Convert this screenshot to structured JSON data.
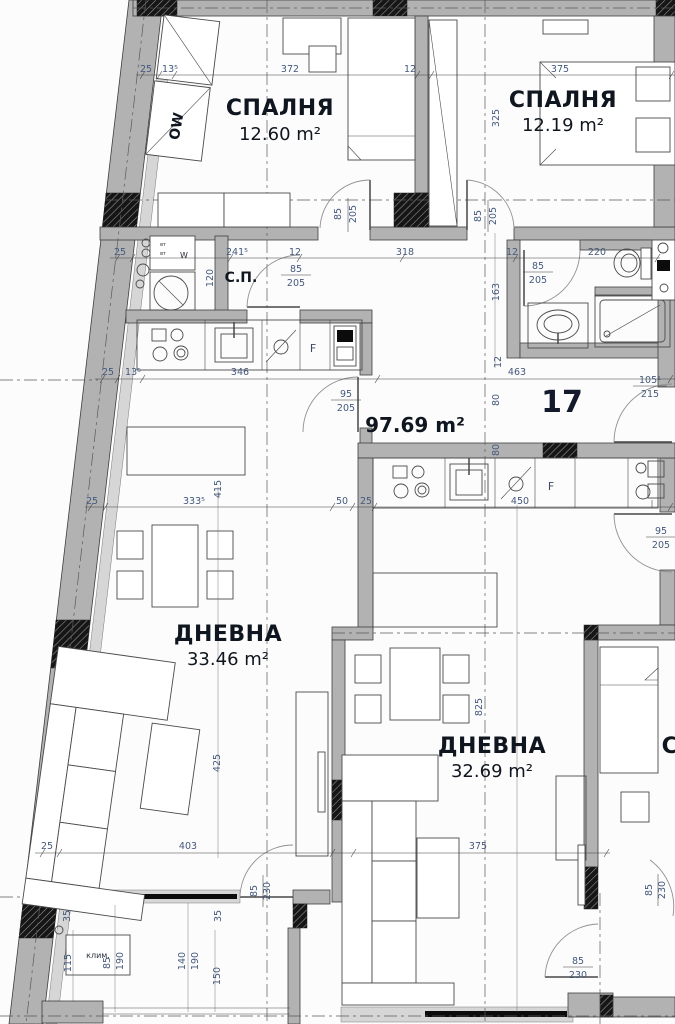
{
  "rooms": {
    "bedroom1": {
      "name": "СПАЛНЯ",
      "area": "12.60 m²"
    },
    "bedroom2": {
      "name": "СПАЛНЯ",
      "area": "12.19 m²"
    },
    "living1": {
      "name": "ДНЕВНА",
      "area": "33.46 m²"
    },
    "living2": {
      "name": "ДНЕВНА",
      "area": "32.69 m²"
    },
    "storage": {
      "name": "С.П."
    },
    "partial": {
      "name": "С"
    }
  },
  "labels": {
    "apartment_number": "17",
    "total_area": "97.69 m²",
    "ac_unit": "клим.",
    "wardrobe_code": "OW",
    "fridge": "F",
    "washer": "W",
    "outlet": "вт"
  },
  "dims": {
    "d12": "12",
    "d25": "25",
    "d35": "35",
    "d50": "50",
    "d80": "80",
    "d85": "85",
    "d95": "95",
    "d115": "115",
    "d120": "120",
    "d140": "140",
    "d150": "150",
    "d163": "163",
    "d190": "190",
    "d205": "205",
    "d215": "215",
    "d220": "220",
    "d230": "230",
    "d241_5": "241⁵",
    "d318": "318",
    "d325": "325",
    "d333_5": "333⁵",
    "d346": "346",
    "d372": "372",
    "d375": "375",
    "d403": "403",
    "d415": "415",
    "d425": "425",
    "d450": "450",
    "d463": "463",
    "d825": "825",
    "d105_1": "105¹",
    "d13_5": "13⁵"
  },
  "colors": {
    "wall": "#b2b2b2",
    "wall_light": "#d6d6d6",
    "line": "#3e3e3e",
    "dimension_text": "#44597c",
    "label_text": "#10161f",
    "window": "#0c0c0c"
  }
}
